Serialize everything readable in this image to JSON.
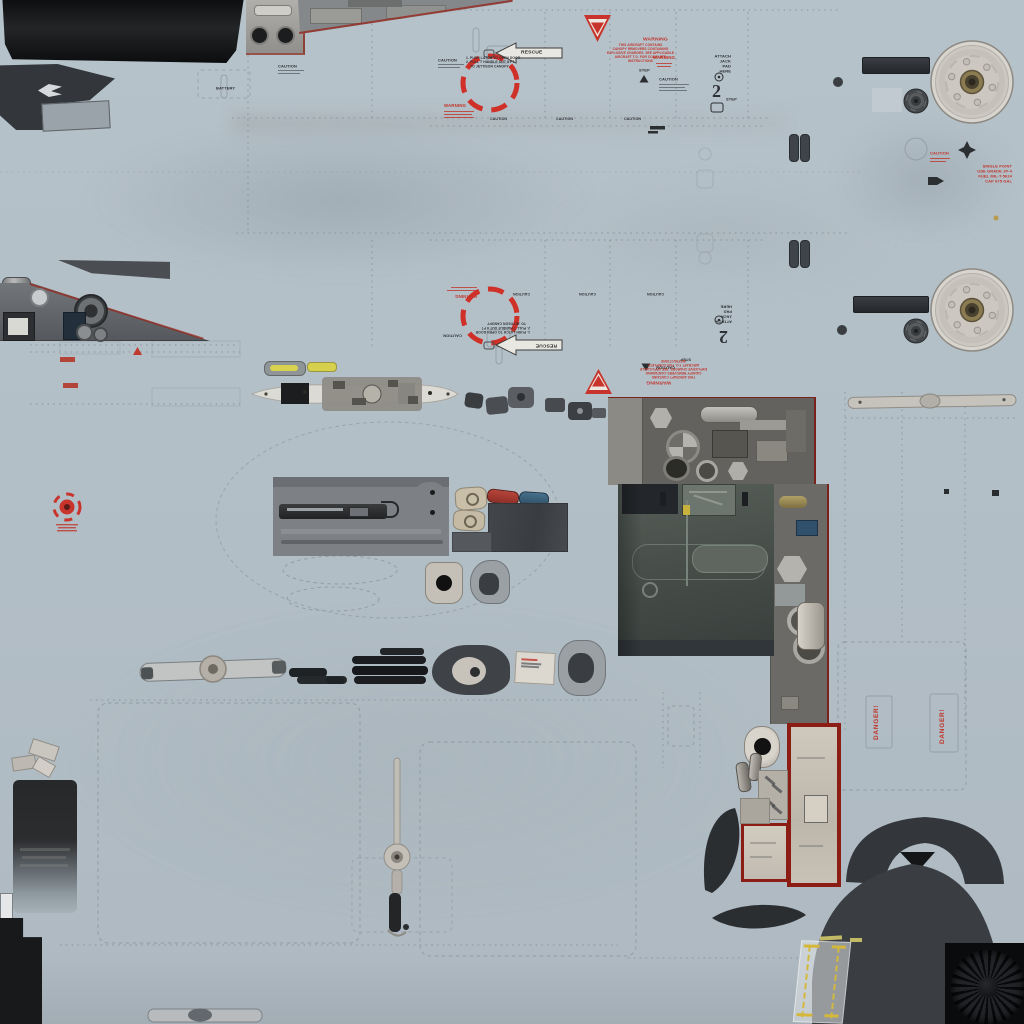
{
  "meta": {
    "description": "Aircraft exterior skin texture atlas (UV map) with maintenance stencils and parts"
  },
  "stencils": {
    "battery": "BATTERY",
    "caution": "CAUTION",
    "warning": "WARNING",
    "step": "STEP",
    "rescue": "RESCUE",
    "danger": "DANGER!",
    "two": "2",
    "attach_jack": "ATTACH\nJACK\nPAD\nHERE",
    "canopy_warning_title": "WARNING",
    "canopy_warning_body": "THIS AIRCRAFT CONTAINS\nCANOPY REMOVERS CONTAINING\nEXPLOSIVE CHARGES. SEE APPLICABLE\nAIRCRAFT T.O. FOR COMPLETE\nINSTRUCTIONS",
    "jettison_steps": "1. PUSH LATCH TO OPEN DOOR\n2. PULL T HANDLE OUT 6 FT\n    TO JETTISON CANOPY",
    "fuel_point": "SINGLE POINT\nUSE GRADE JP-4\nFUEL MIL-T-5624\nCAP 675 GAL"
  },
  "colors": {
    "background": "#b5c1c9",
    "panel_line": "#7e8890",
    "stencil_black": "#2e3135",
    "stencil_red": "#c0342a",
    "decal_frame_red": "#8b1d15",
    "canopy_black": "#17191b",
    "metal_gray": "#85888b",
    "bay_green": "#4b544f",
    "marking_yellow": "#d4b83c",
    "light_yellow_green": "#d8d24e"
  }
}
